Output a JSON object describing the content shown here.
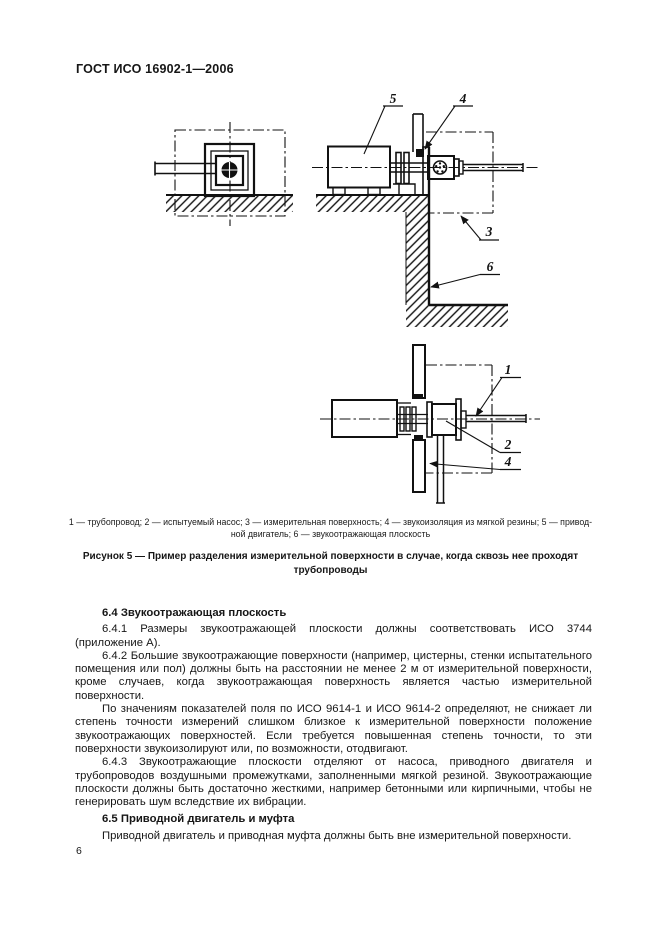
{
  "header": {
    "title": "ГОСТ ИСО 16902-1—2006"
  },
  "figure": {
    "callouts": {
      "top_5": "5",
      "top_4": "4",
      "top_3": "3",
      "top_6": "6",
      "bot_1": "1",
      "bot_2": "2",
      "bot_4": "4"
    },
    "legend_line1": "1 — трубопровод; 2 — испытуемый насос; 3 — измерительная поверхность; 4 — звукоизоляция из мягкой резины; 5 — привод-",
    "legend_line2": "ной двигатель; 6 — звукоотражающая плоскость",
    "caption_line1": "Рисунок  5 — Пример разделения измерительной поверхности в случае, когда сквозь нее проходят",
    "caption_line2": "трубопроводы"
  },
  "content": {
    "heading_64": "6.4  Звукоотражающая плоскость",
    "para_641": "6.4.1  Размеры звукоотражающей плоскости должны соответствовать ИСО 3744 (приложение А).",
    "para_642a": "6.4.2  Большие звукоотражающие поверхности (например, цистерны, стенки испытательного помещения или пол) должны быть на расстоянии не менее 2 м от измерительной поверхности, кроме случаев, когда звукоотражающая поверхность является частью измерительной поверхности.",
    "para_642b": "По значениям показателей поля по ИСО 9614-1 и ИСО 9614-2 определяют, не снижает ли степень точности измерений слишком близкое к измерительной поверхности положение звукоотражающих поверхностей. Если требуется повышенная степень точности, то эти поверхности звукоизолируют или, по возможности, отодвигают.",
    "para_643": "6.4.3  Звукоотражающие плоскости отделяют от насоса, приводного двигателя и трубопроводов воздушными промежутками, заполненными мягкой резиной. Звукоотражающие плоскости должны быть достаточно жесткими, например бетонными или кирпичными, чтобы не генерировать шум вследствие их вибрации.",
    "heading_65": "6.5  Приводной двигатель и муфта",
    "para_65": "Приводной двигатель и приводная муфта должны быть вне измерительной поверхности."
  },
  "footer": {
    "page_number": "6"
  }
}
